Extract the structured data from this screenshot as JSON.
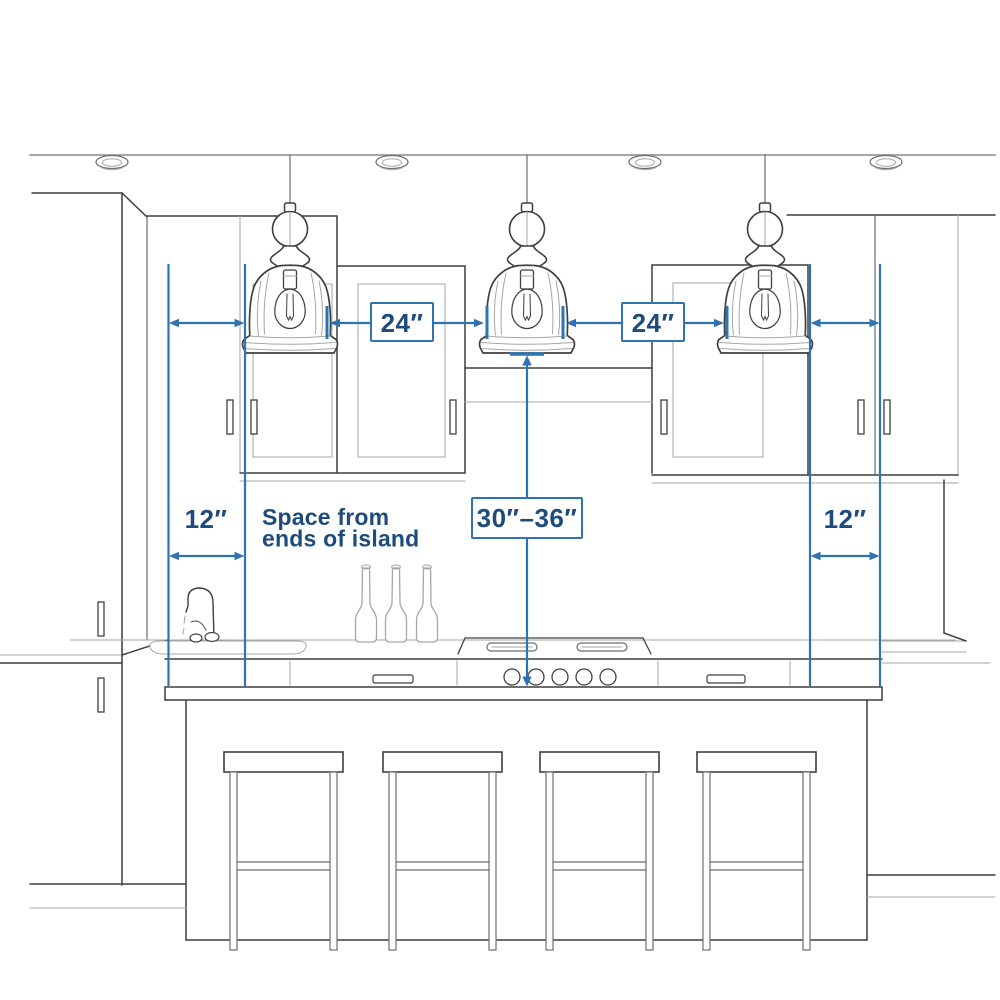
{
  "diagram": {
    "type": "kitchen-island-pendant-spacing-guide",
    "labels": {
      "pendant_gap_left": "24″",
      "pendant_gap_right": "24″",
      "height_above_counter": "30″–36″",
      "end_space_left": "12″",
      "end_space_right": "12″",
      "note_line1": "Space from",
      "note_line2": "ends of island"
    },
    "scene": {
      "pendant_count": 3,
      "bar_stool_count": 4,
      "recessed_light_count": 4
    },
    "colors": {
      "dimension_blue": "#2e74b4",
      "label_navy": "#1c4b7c",
      "sketch_dark": "#3f3f3f",
      "sketch_light": "#a6a6a6",
      "background": "#ffffff"
    }
  }
}
